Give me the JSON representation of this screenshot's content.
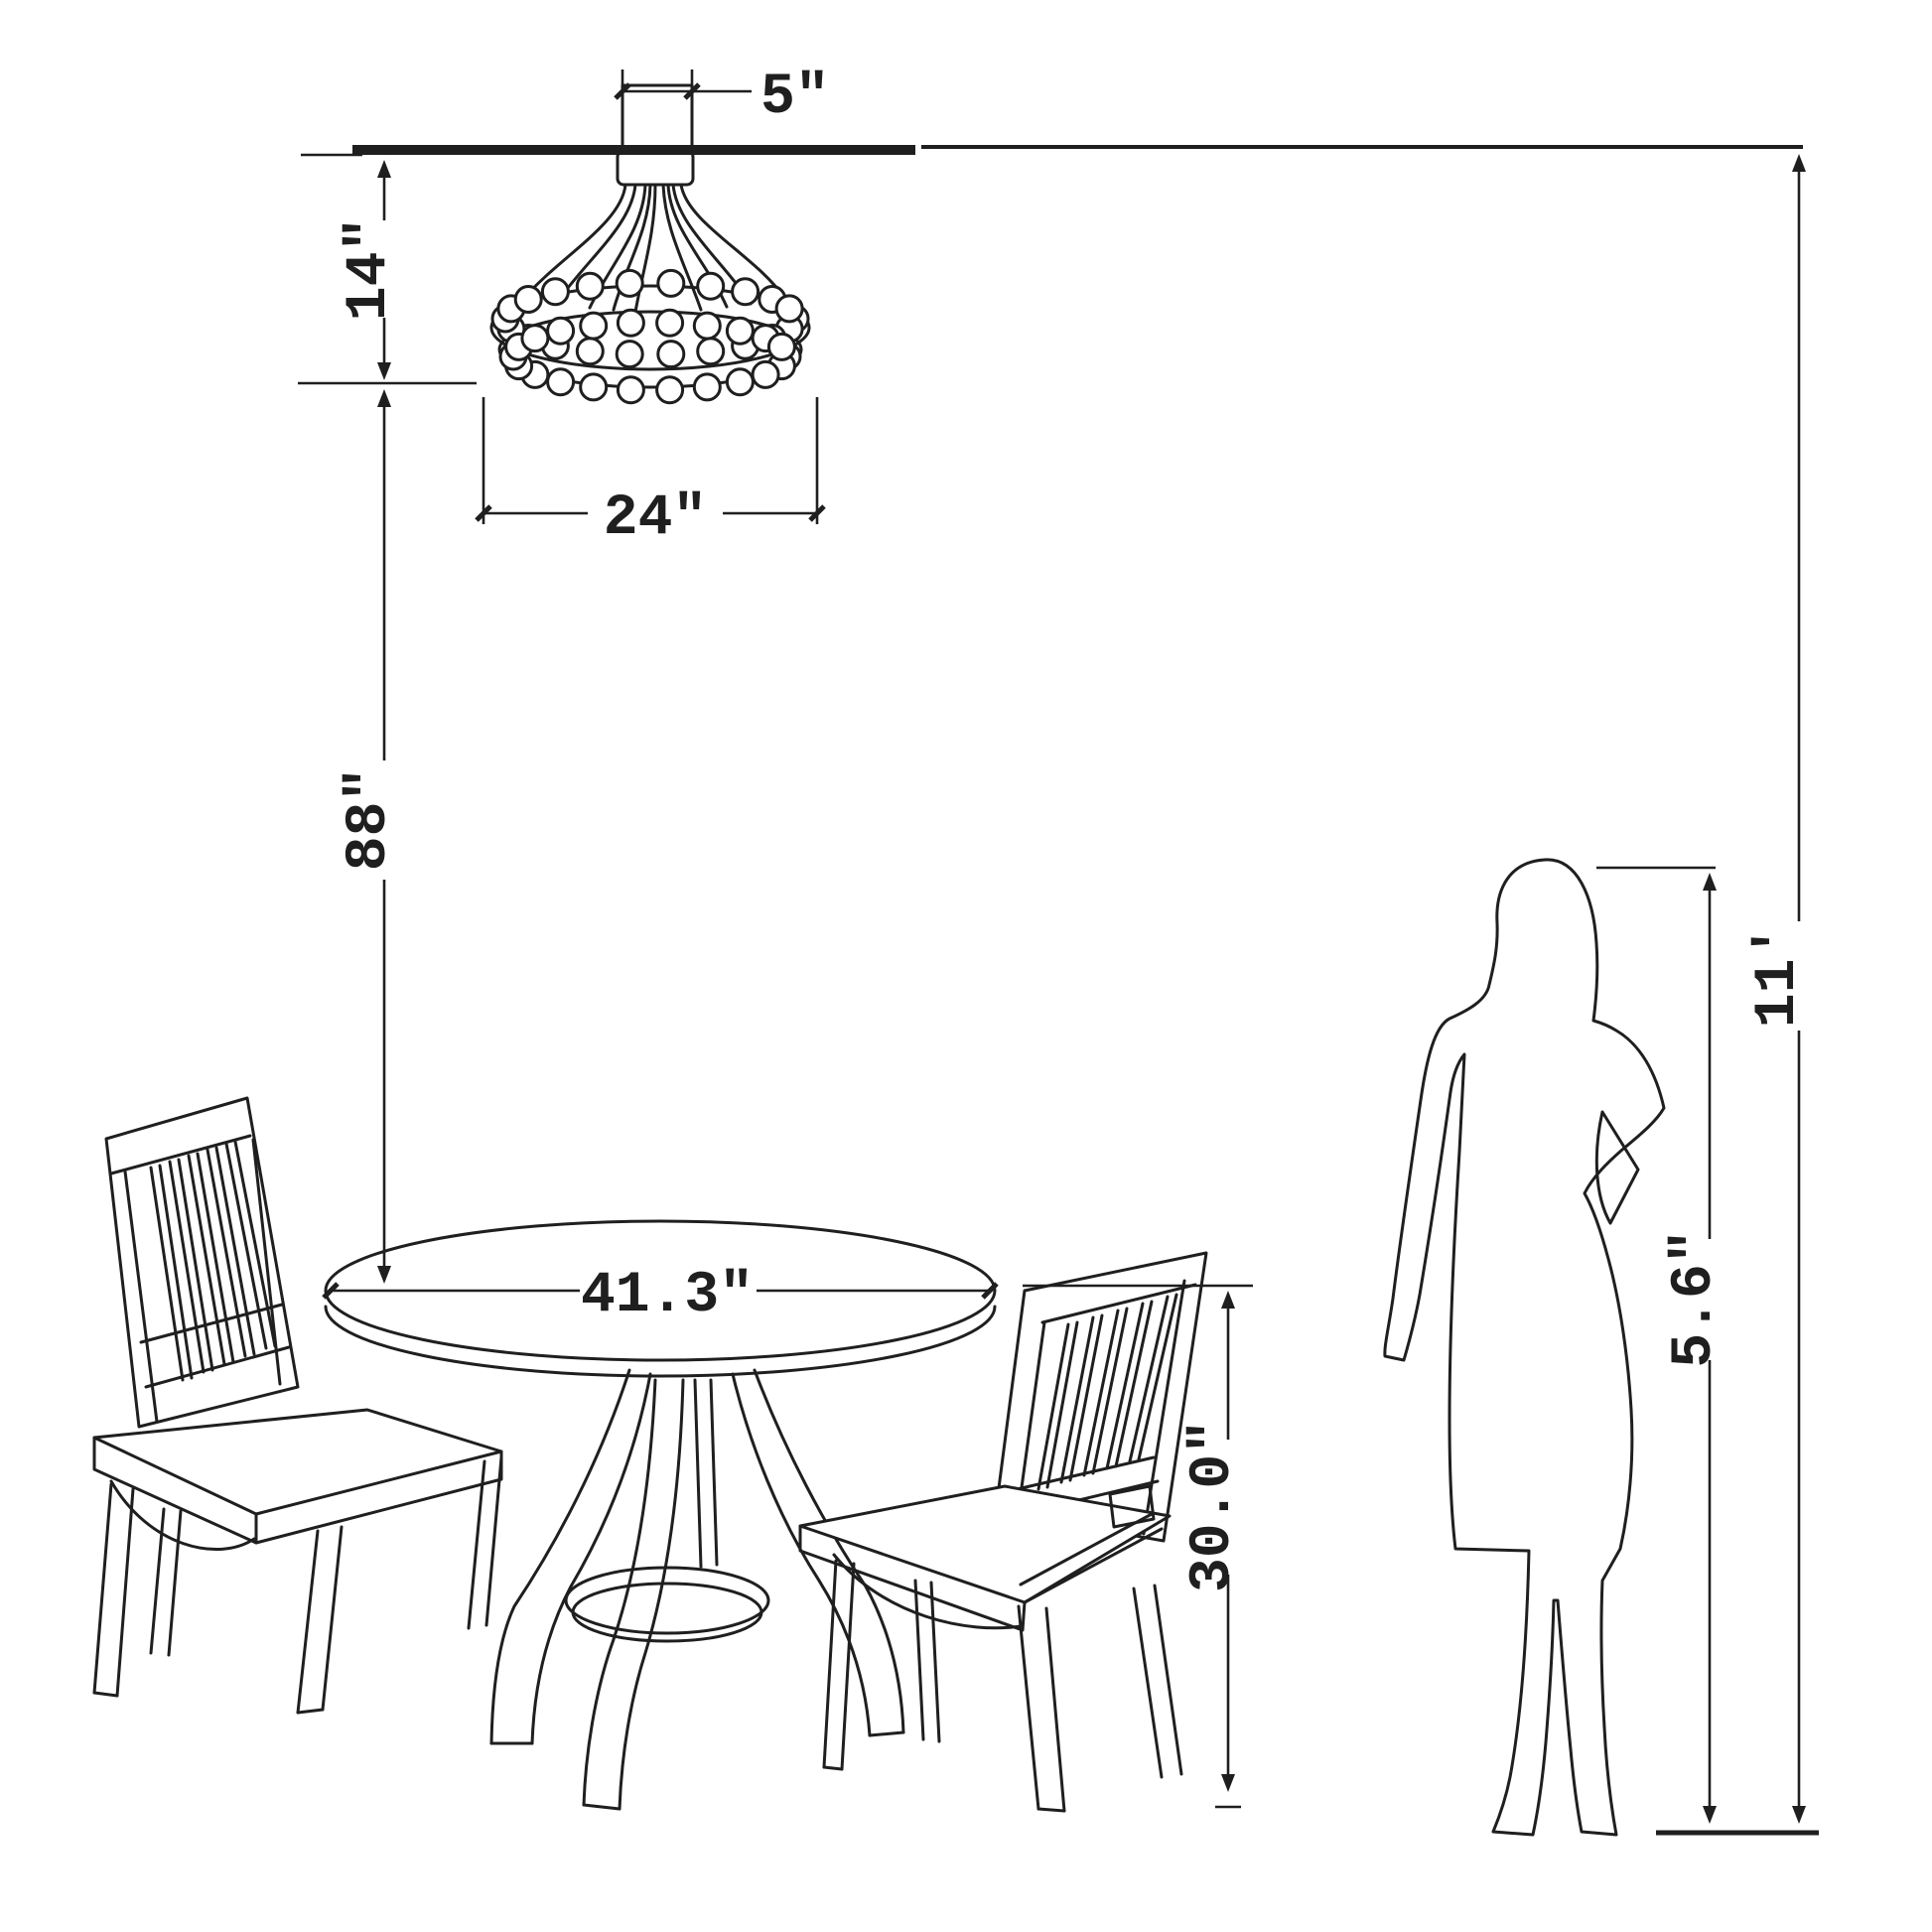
{
  "diagram": {
    "kind": "furniture dimension drawing",
    "background_color": "#ffffff",
    "line_color": "#1f1f1f",
    "objects": [
      "ceiling line",
      "beaded chandelier with ceiling canopy",
      "round pedestal dining table",
      "slat-back dining chair (left)",
      "slat-back dining chair (right)",
      "standing woman silhouette",
      "floor line"
    ]
  },
  "dimensions": {
    "canopy_width": {
      "label": "5\"",
      "value": 5,
      "unit": "in",
      "orientation": "horizontal"
    },
    "fixture_height": {
      "label": "14\"",
      "value": 14,
      "unit": "in",
      "orientation": "vertical"
    },
    "fixture_diameter": {
      "label": "24\"",
      "value": 24,
      "unit": "in",
      "orientation": "horizontal"
    },
    "fixture_to_table": {
      "label": "88\"",
      "value": 88,
      "unit": "in",
      "orientation": "vertical"
    },
    "table_diameter": {
      "label": "41.3\"",
      "value": 41.3,
      "unit": "in",
      "orientation": "horizontal"
    },
    "table_height": {
      "label": "30.0\"",
      "value": 30.0,
      "unit": "in",
      "orientation": "vertical"
    },
    "person_height": {
      "label": "5.6\"",
      "value": 5.6,
      "unit": "",
      "orientation": "vertical"
    },
    "ceiling_height": {
      "label": "11'",
      "value": 11,
      "unit": "ft",
      "orientation": "vertical"
    }
  }
}
